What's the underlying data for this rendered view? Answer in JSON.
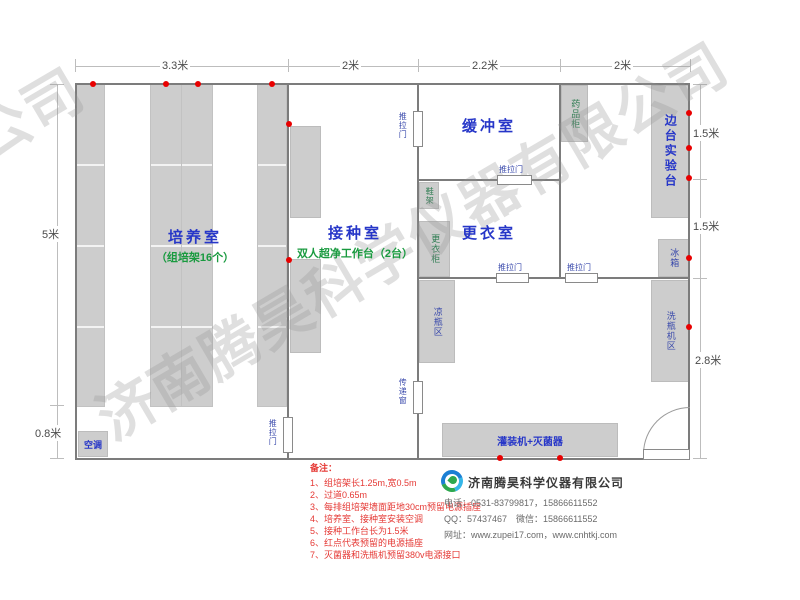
{
  "watermark": {
    "text": "济南腾昊科学仪器有限公司",
    "partial": "有限公司"
  },
  "dimensions": {
    "top": [
      "3.3米",
      "2米",
      "2.2米",
      "2米"
    ],
    "left": [
      "5米",
      "0.8米"
    ],
    "right": [
      "1.5米",
      "1.5米",
      "2.8米"
    ]
  },
  "rooms": {
    "culture": {
      "name": "培养室",
      "sub": "（组培架16个）"
    },
    "inoculation": {
      "name": "接种室",
      "sub": "双人超净工作台（2台）"
    },
    "buffer": {
      "name": "缓冲室"
    },
    "changing": {
      "name": "更衣室"
    }
  },
  "equipment": {
    "ac": "空调",
    "medicine_cabinet": "药品柜",
    "side_bench": "边台实验台",
    "fridge": "冰箱",
    "shoe_rack": "鞋架",
    "wardrobe": "更衣柜",
    "cool_bottle_area": "凉瓶区",
    "bottle_washer_area": "洗瓶机区",
    "filler_sterilizer": "灌装机+灭菌器"
  },
  "doors": {
    "sliding": "推拉门",
    "transfer_window": "传递窗"
  },
  "notes": {
    "title": "备注：",
    "items": [
      "1、组培架长1.25m,宽0.5m",
      "2、过道0.65m",
      "3、每排组培架墙面距地30cm预留电源插座",
      "4、培养室、接种室安装空调",
      "5、接种工作台长为1.5米",
      "6、红点代表预留的电源插座",
      "7、灭菌器和洗瓶机预留380v电源接口"
    ]
  },
  "company": {
    "name": "济南腾昊科学仪器有限公司",
    "phone": "电话：0531-83799817，15866611552",
    "qq_wechat": "QQ：57437467　微信：15866611552",
    "website": "网址：www.zupei17.com，www.cnhtkj.com"
  },
  "colors": {
    "accent_blue": "#2636c8",
    "accent_green": "#199a3f",
    "note_red": "#e53935",
    "outlet_red": "#e80000"
  }
}
